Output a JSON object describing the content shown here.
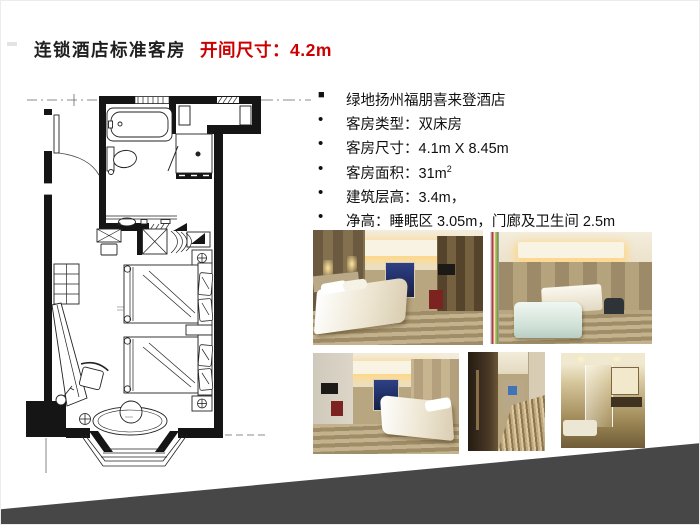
{
  "slide": {
    "title": "连锁酒店标准客房",
    "dimension_label": "开间尺寸：4.2m",
    "colors": {
      "accent_red": "#CC0000",
      "title_dark": "#1F1F1F",
      "triangle_gray": "#474747"
    }
  },
  "specs": {
    "items": [
      {
        "bullet": "■",
        "text": "绿地扬州福朋喜来登酒店",
        "sup": ""
      },
      {
        "bullet": "•",
        "text": "客房类型：双床房",
        "sup": ""
      },
      {
        "bullet": "•",
        "text": "客房尺寸：4.1m X 8.45m",
        "sup": ""
      },
      {
        "bullet": "•",
        "text": "客房面积：31m",
        "sup": "2"
      },
      {
        "bullet": "•",
        "text": "建筑层高：3.4m，",
        "sup": ""
      },
      {
        "bullet": "•",
        "text": "净高：睡眠区 3.05m，门廊及卫生间 2.5m",
        "sup": ""
      }
    ]
  }
}
